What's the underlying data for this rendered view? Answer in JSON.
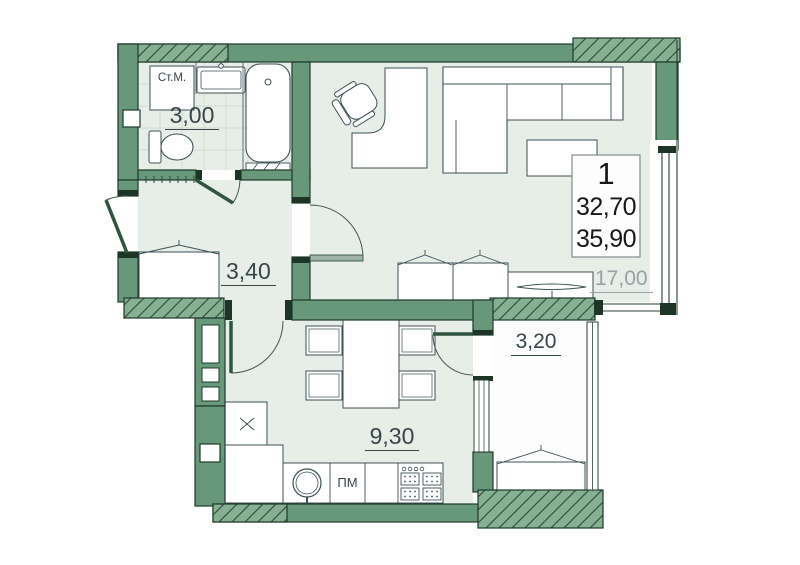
{
  "title": "apartment-floor-plan",
  "info_box": {
    "rooms_count": "1",
    "living_area": "32,70",
    "total_area": "35,90"
  },
  "room_labels": {
    "bathroom": "3,00",
    "hallway": "3,40",
    "kitchen": "9,30",
    "loggia": "3,20",
    "living_room": "17,00"
  },
  "appliance_labels": {
    "washing_machine": "Ст.М.",
    "dishwasher": "ПМ"
  },
  "colors": {
    "wall": "#669879",
    "wall_hatch": "#86b092",
    "wall_outline": "#1f3a2b",
    "room_fill": "#e7ede7",
    "loggia_fill": "#ffffff",
    "furniture_outline": "#3e5156",
    "label_text": "#37444a",
    "label_muted": "#98a1a5"
  }
}
